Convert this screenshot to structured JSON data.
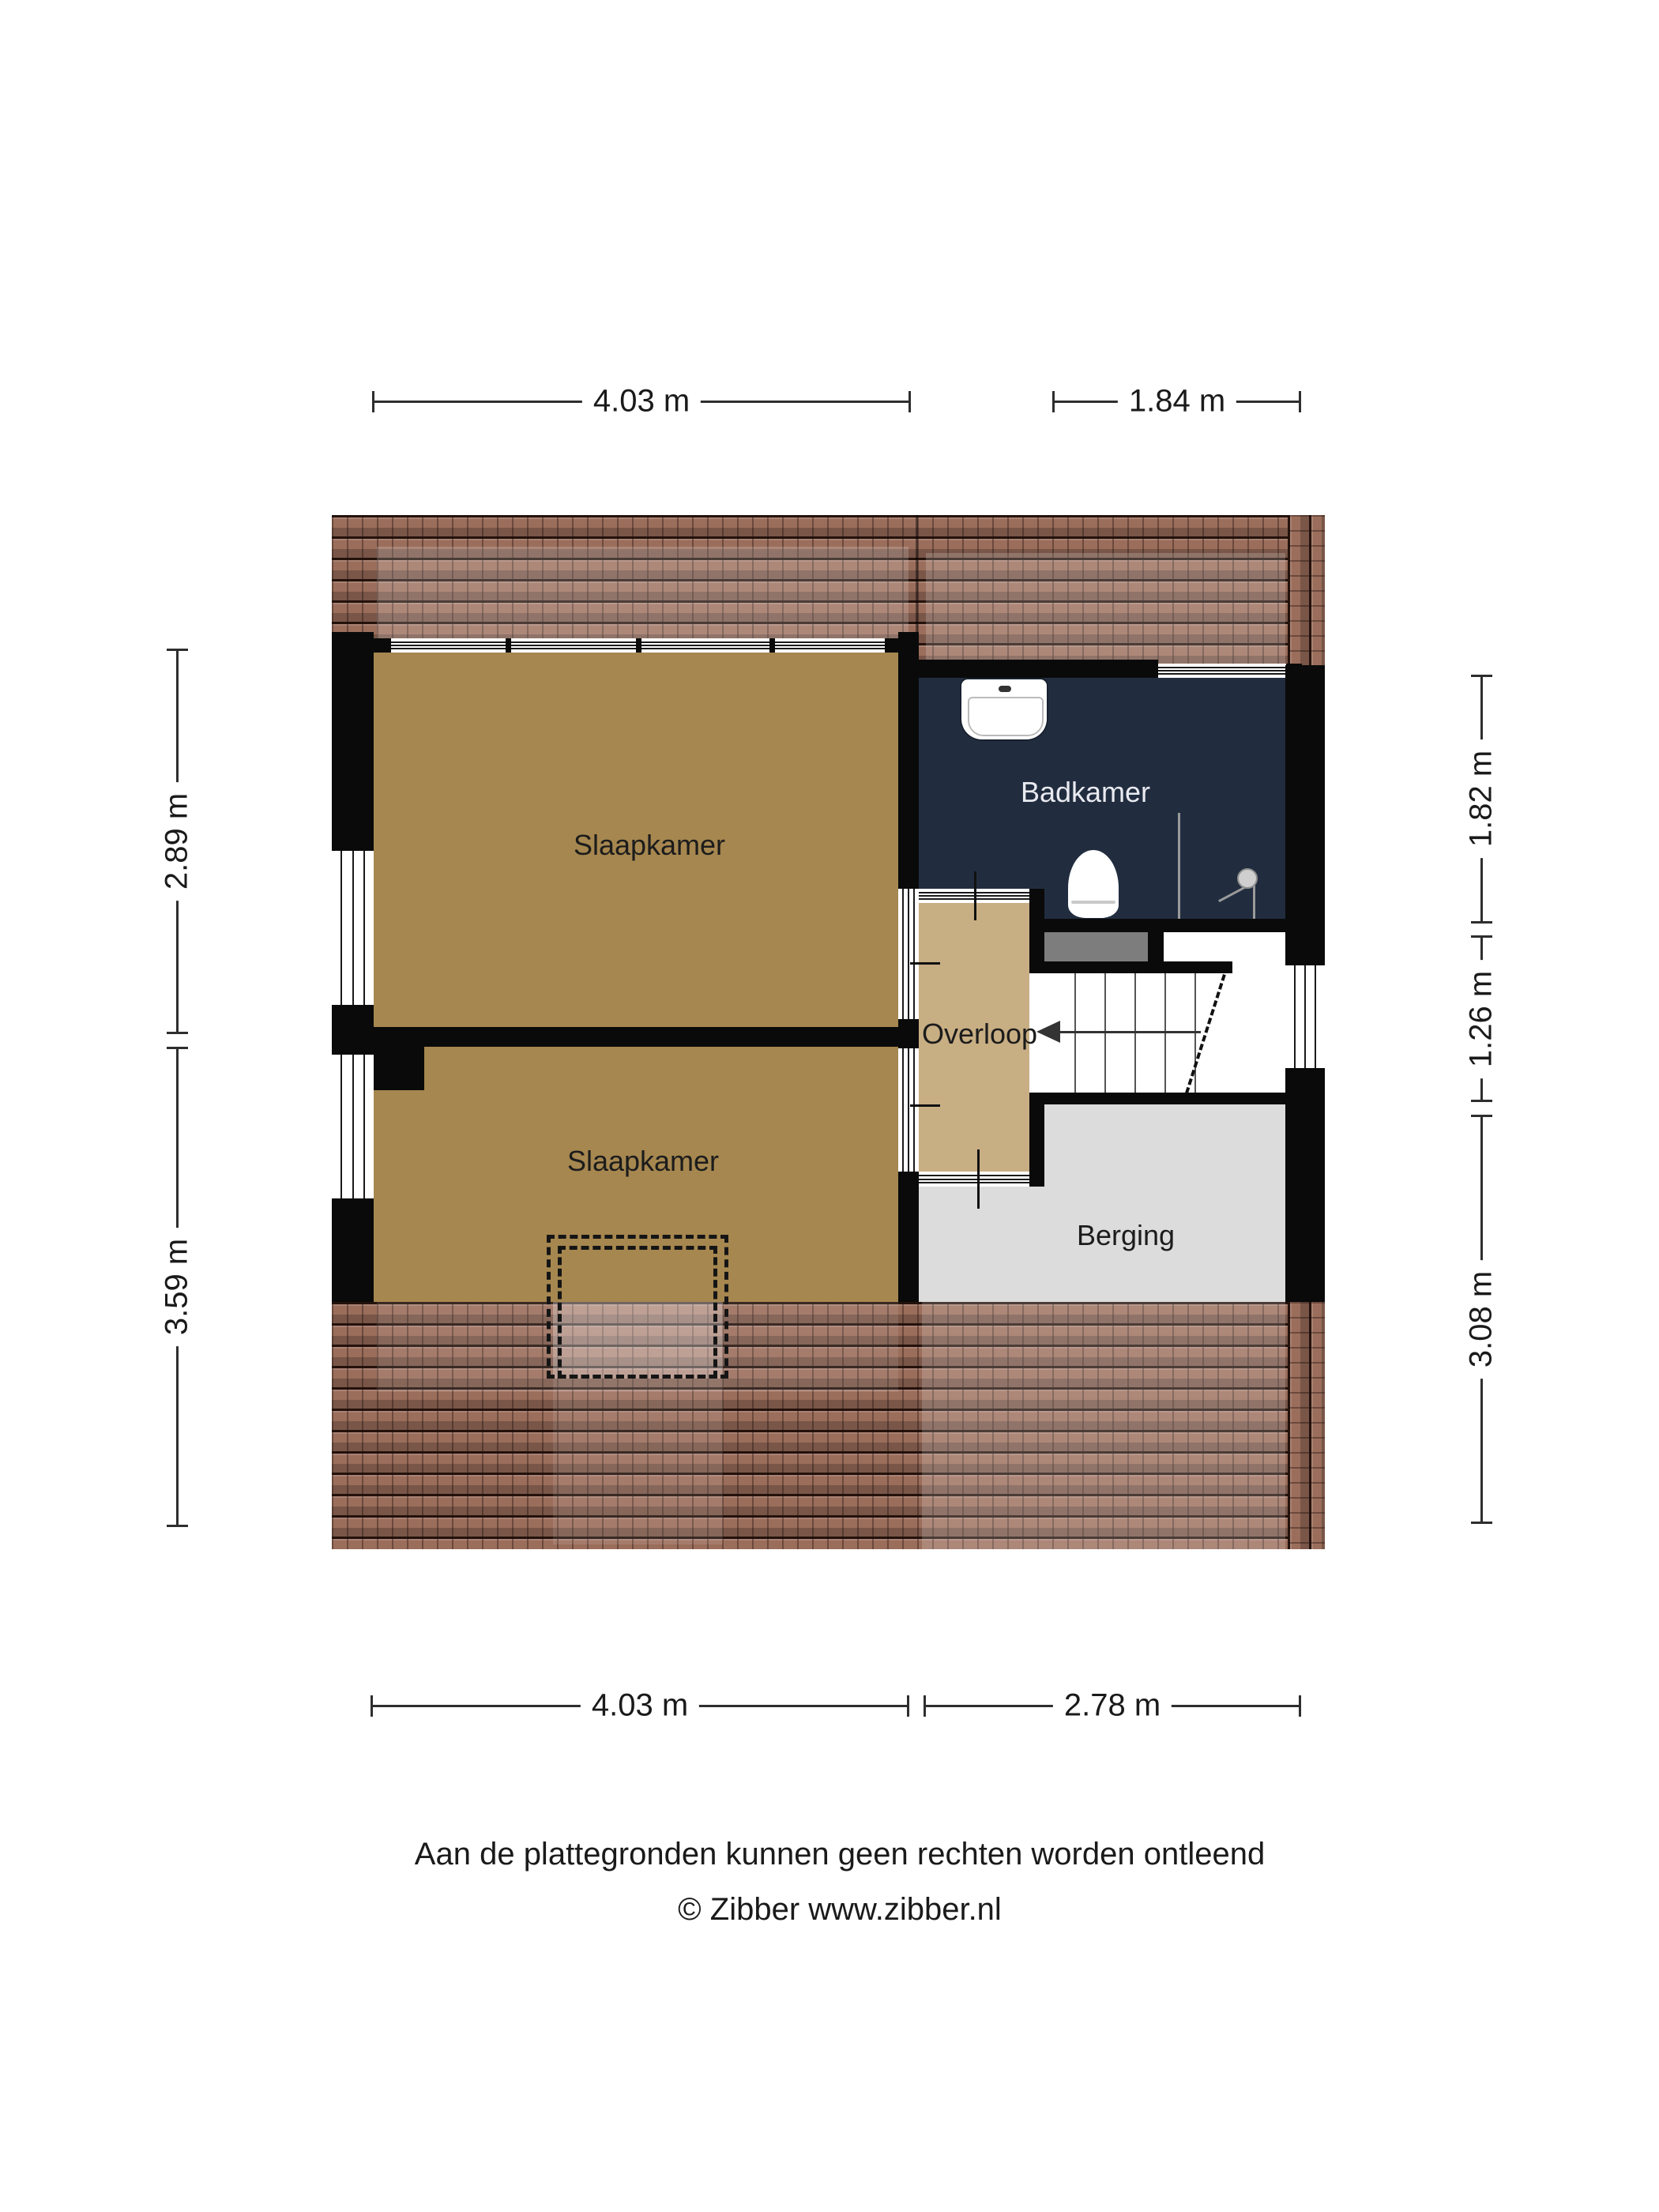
{
  "floorplan": {
    "type": "residential-floor-plan-attic-storey",
    "rooms": [
      {
        "id": "slaapkamer-top",
        "label": "Slaapkamer"
      },
      {
        "id": "slaapkamer-bottom",
        "label": "Slaapkamer"
      },
      {
        "id": "badkamer",
        "label": "Badkamer"
      },
      {
        "id": "overloop",
        "label": "Overloop"
      },
      {
        "id": "berging",
        "label": "Berging"
      }
    ],
    "fixtures": [
      "sink-icon",
      "toilet-icon",
      "shower-icon",
      "staircase-with-down-arrow",
      "roof-window-dashed-outline"
    ],
    "colors": {
      "bedroom_floor": "#a6874f",
      "landing_floor": "#c8ae83",
      "bathroom_floor": "#212d3f",
      "storage_floor": "#dcdcdc",
      "roof_tiles": "#9b6e5c",
      "walls": "#0a0a0a",
      "shower_tray_gray": "#7d7d7d"
    }
  },
  "dimensions": {
    "top": [
      {
        "label": "4.03 m"
      },
      {
        "label": "1.84 m"
      }
    ],
    "bottom": [
      {
        "label": "4.03 m"
      },
      {
        "label": "2.78 m"
      }
    ],
    "left": [
      {
        "label": "2.89 m"
      },
      {
        "label": "3.59 m"
      }
    ],
    "right": [
      {
        "label": "1.82 m"
      },
      {
        "label": "1.26 m"
      },
      {
        "label": "3.08 m"
      }
    ]
  },
  "footer": {
    "line1": "Aan de plattegronden kunnen geen rechten worden ontleend",
    "line2": "© Zibber www.zibber.nl"
  }
}
